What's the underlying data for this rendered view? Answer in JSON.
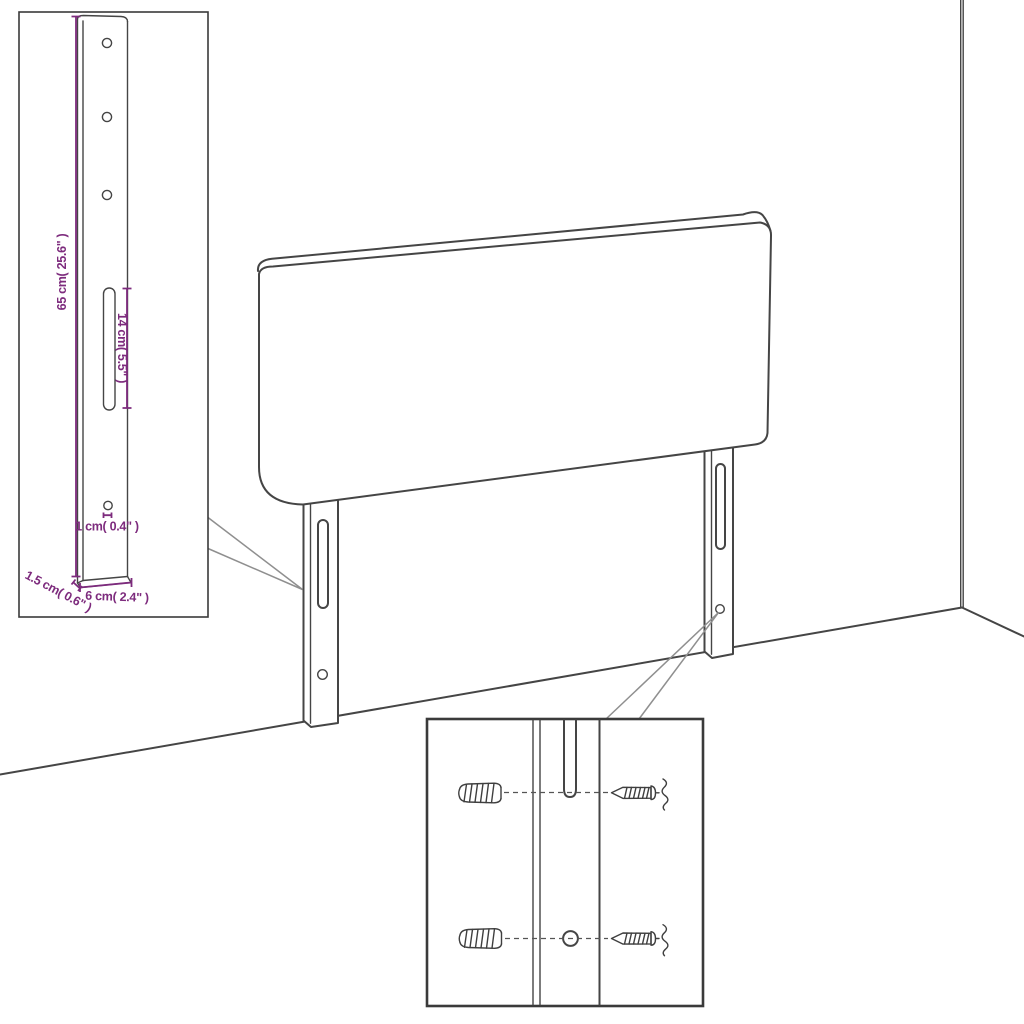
{
  "page": {
    "background": "#ffffff"
  },
  "colors": {
    "line": "#454545",
    "accent_dimension": "#7D2B7D",
    "callout": "#8f8f8f",
    "box_border": "#3a3a3a"
  },
  "icons": {
    "wall_plug": "wall-plug-sketch",
    "screw": "wood-screw-sketch"
  },
  "bracket_detail": {
    "height_label": "65 cm( 25.6\" )",
    "slot_label": "14 cm( 5.5\" )",
    "hole_label": "1 cm( 0.4\" )",
    "thickness_label": "1.5 cm( 0.6\" )",
    "width_label": "6 cm( 2.4\" )"
  }
}
